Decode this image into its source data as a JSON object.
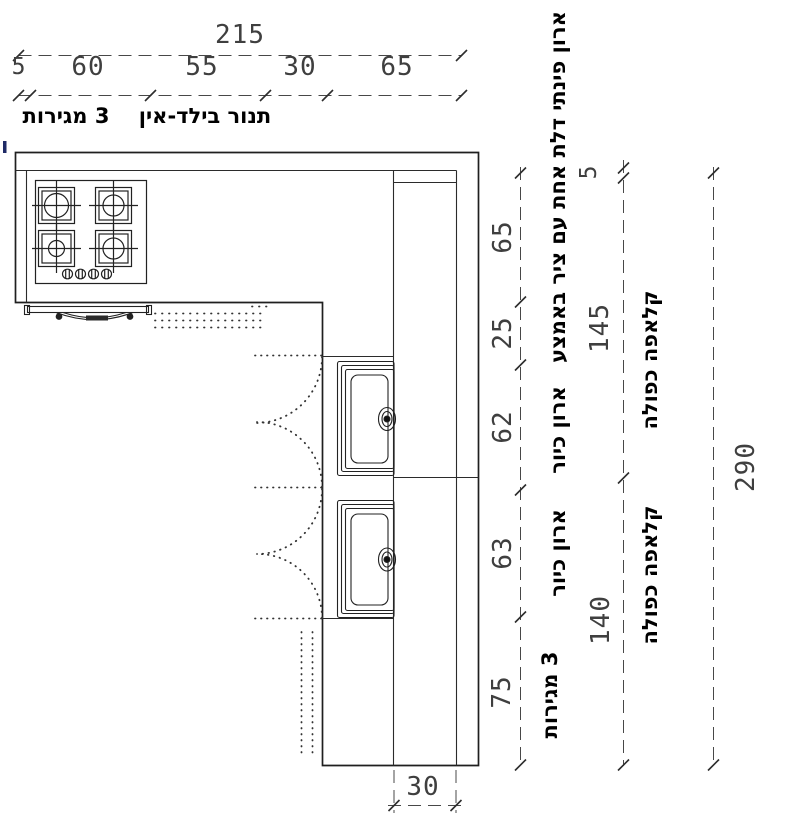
{
  "drawing": {
    "type": "kitchen-plan",
    "dims": {
      "top_total": "215",
      "top_segments": [
        "5",
        "60",
        "55",
        "30",
        "65"
      ],
      "right_segments": [
        "65",
        "25",
        "62",
        "63",
        "75"
      ],
      "mid_segments": [
        "5",
        "145",
        "140"
      ],
      "overall_height": "290",
      "bottom_depth": "30"
    },
    "labels": {
      "drawers_top": "3 מגירות",
      "oven_built_in": "תנור בילד-אין",
      "corner_cabinet": "ארון פינתי דלת אחת עם ציר באמצע",
      "sink_cabinet_1": "ארון כיור",
      "sink_cabinet_2": "ארון כיור",
      "double_flap_1": "קלאפה כפולה",
      "double_flap_2": "קלאפה כפולה",
      "drawers_bottom": "3 מגירות"
    },
    "colors": {
      "wall_line": "#1f1f1f",
      "dim_line": "#484848",
      "label_text": "#000000",
      "accent_tick": "#1f2a66"
    }
  }
}
